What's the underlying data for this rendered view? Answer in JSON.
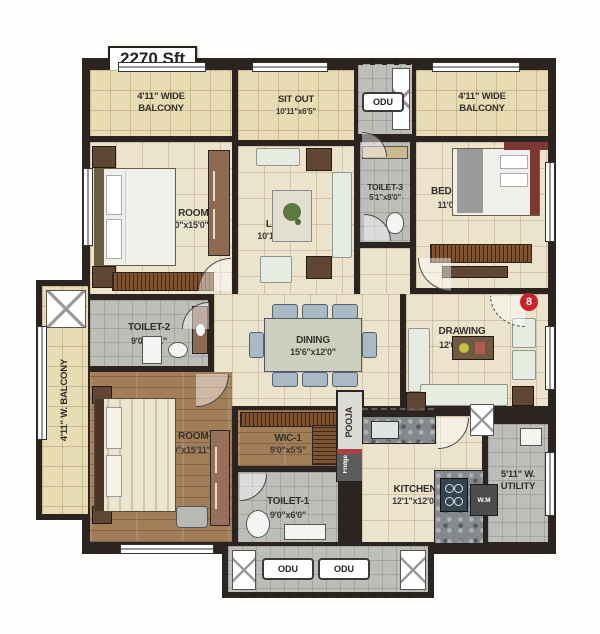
{
  "title": "2270 Sft",
  "unit_number": "8",
  "rooms": {
    "balcony_top_left": {
      "line1": "4'11\" WIDE",
      "line2": "BALCONY"
    },
    "sit_out": {
      "name": "SIT OUT",
      "dims": "10'11\"x6'5\""
    },
    "odu_top": {
      "name": "ODU"
    },
    "balcony_top_right": {
      "line1": "4'11\" WIDE",
      "line2": "BALCONY"
    },
    "bed_room_2": {
      "name": "BED ROOM-2",
      "dims": "11'0\"x15'0\""
    },
    "living": {
      "name": "LIVING",
      "dims": "10'11\"x11'0\""
    },
    "toilet_3": {
      "name": "TOILET-3",
      "dims": "5'1\"x8'0\""
    },
    "bed_room_3": {
      "name": "BED ROOM-3",
      "dims": "11'0\"x11'11\""
    },
    "balcony_left": {
      "name": "4'11\" W. BALCONY"
    },
    "toilet_2": {
      "name": "TOILET-2",
      "dims": "9'0\"x5'1\""
    },
    "dining": {
      "name": "DINING",
      "dims": "15'6\"x12'0\""
    },
    "drawing": {
      "name": "DRAWING",
      "dims": "12'0\"x12'0\""
    },
    "bed_room_1": {
      "name": "BED ROOM-1",
      "dims": "11'0\"x15'11\""
    },
    "wic_1": {
      "name": "WIC-1",
      "dims": "9'0\"x5'5\""
    },
    "toilet_1": {
      "name": "TOILET-1",
      "dims": "9'0\"x6'0\""
    },
    "pooja": {
      "name": "POOJA"
    },
    "kitchen": {
      "name": "KITCHEN",
      "dims": "12'1\"x12'0\""
    },
    "utility": {
      "line1": "5'11\" W.",
      "line2": "UTILITY"
    },
    "odu_bottom_1": {
      "name": "ODU"
    },
    "odu_bottom_2": {
      "name": "ODU"
    }
  },
  "appliances": {
    "washing_machine": "W.M",
    "fridge": "Fridge"
  },
  "colors": {
    "wall": "#2b2420",
    "floor_tile": "#ece3cd",
    "balcony_tile": "#e8dcb4",
    "gray_tile": "#bdbeba",
    "wood_floor": "#a27e58",
    "accent_red": "#cf2027"
  }
}
